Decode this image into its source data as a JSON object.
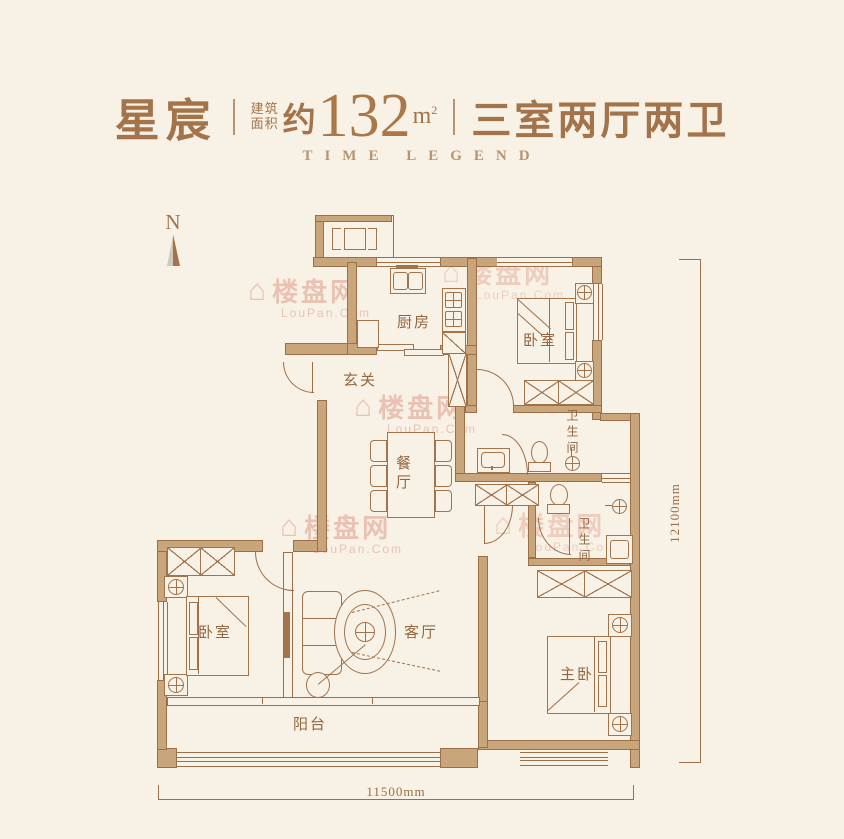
{
  "header": {
    "name": "星宸",
    "divider": "|",
    "area_label_line1": "建筑",
    "area_label_line2": "面积",
    "area_prefix": "约",
    "area_value": "132",
    "area_unit": "m",
    "area_unit_exp": "2",
    "layout": "三室两厅两卫",
    "brand": "TIME LEGEND"
  },
  "compass": {
    "label": "N"
  },
  "rooms": {
    "kitchen": "厨房",
    "entry": "玄关",
    "bedroom_top": "卧室",
    "bathroom_top": "卫生间",
    "dining": "餐厅",
    "bathroom_mid": "卫生间",
    "bedroom_left": "卧室",
    "living": "客厅",
    "master_bedroom": "主卧",
    "balcony": "阳台"
  },
  "dimensions": {
    "right": "12100mm",
    "bottom": "11500mm"
  },
  "watermark": {
    "icon": "⌂",
    "text": "楼盘网",
    "subtext": "LouPan.Com"
  },
  "colors": {
    "background": "#f8f1e5",
    "wall_fill": "#c9a57c",
    "line": "#9c6f48",
    "title": "#a3734a",
    "brand": "#b8956f",
    "watermark": "#dc9480"
  }
}
